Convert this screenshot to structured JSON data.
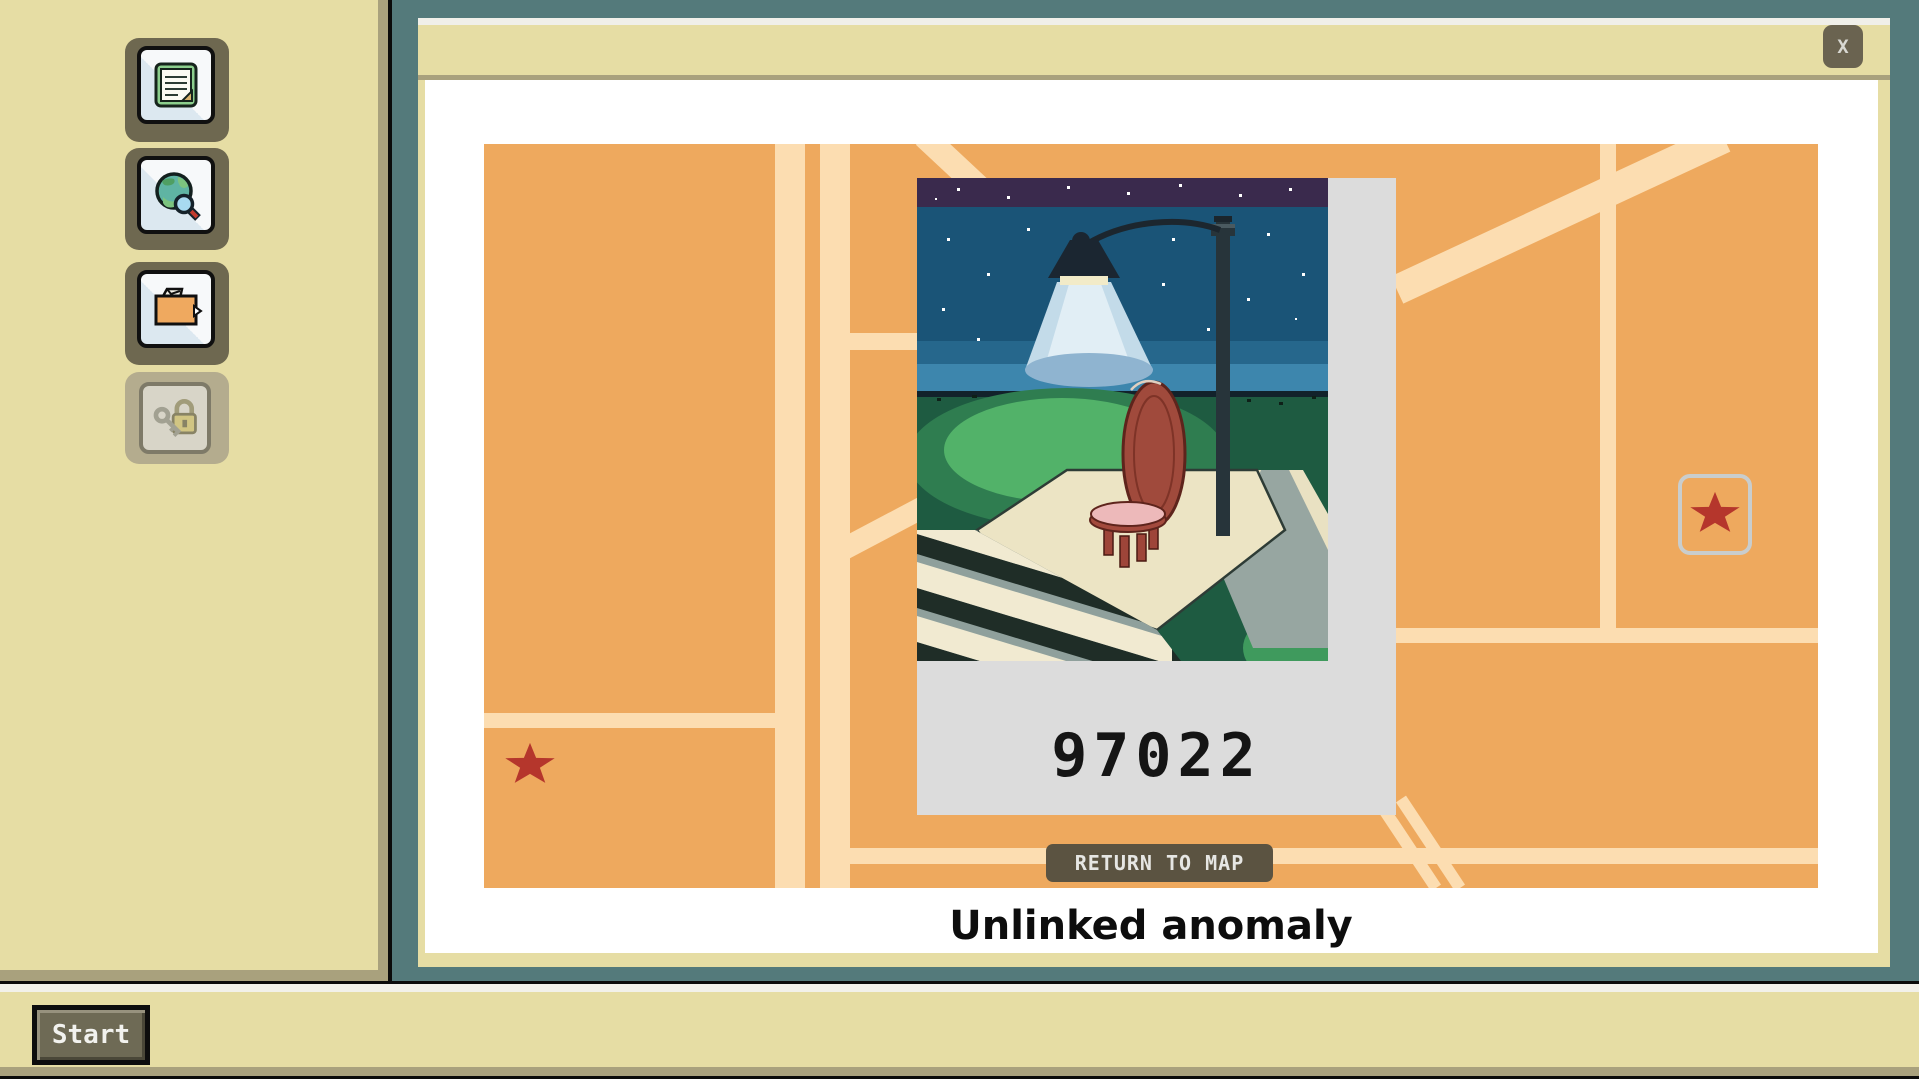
{
  "desktop": {
    "icons": [
      {
        "id": "notes",
        "disabled": false
      },
      {
        "id": "web-search",
        "disabled": false
      },
      {
        "id": "files",
        "disabled": false
      },
      {
        "id": "locked",
        "disabled": true
      }
    ]
  },
  "taskbar": {
    "start_label": "Start"
  },
  "window": {
    "title": "",
    "close_glyph": "X",
    "map": {
      "markers": [
        {
          "id": "anomaly-star-left",
          "type": "star",
          "selected": false
        },
        {
          "id": "anomaly-star-right",
          "type": "star",
          "selected": true
        }
      ]
    },
    "viewer": {
      "photo_id": "97022",
      "return_label": "RETURN TO MAP",
      "caption": "Unlinked anomaly"
    }
  },
  "colors": {
    "desktop_bg": "#547a7b",
    "panel": "#e6dda4",
    "panel_border": "#a9a17d",
    "map_bg": "#eea95e",
    "road": "#fcddb1",
    "star": "#b5362c",
    "marker_box_border": "#c9cdcd",
    "return_button_bg": "#5b5341",
    "polaroid": "#dcdcdc",
    "button_face": "#6e6850"
  }
}
